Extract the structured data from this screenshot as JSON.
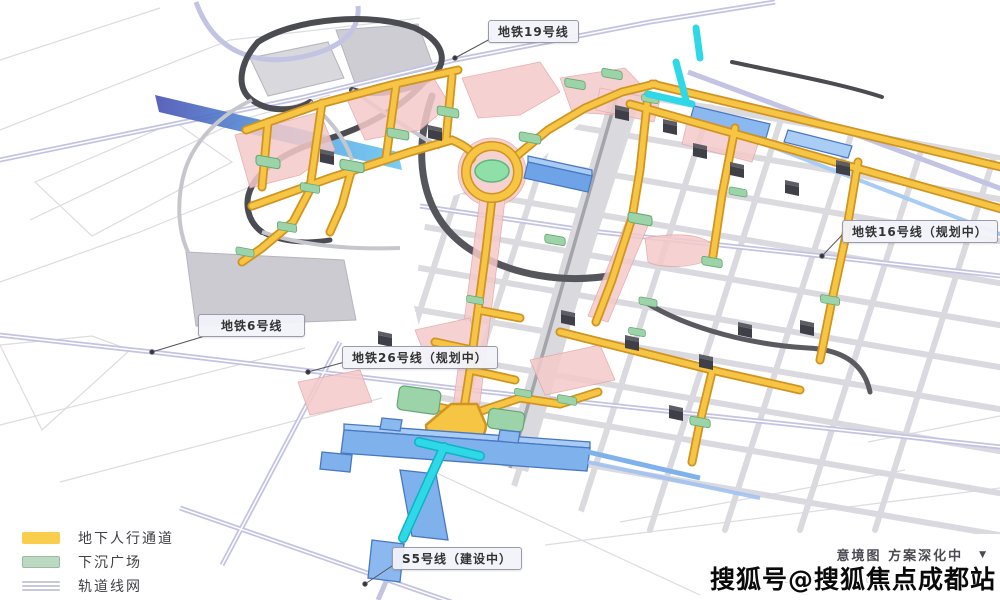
{
  "map": {
    "labels": {
      "line19": "地铁19号线",
      "line16": "地铁16号线（规划中）",
      "line6": "地铁6号线",
      "line26": "地铁26号线（规划中）",
      "s5": "S5号线（建设中）"
    },
    "colors": {
      "pedestrian_corridor": "#F6C544",
      "sunken_plaza": "#9CD3A8",
      "rail_network": "#C6C6E2",
      "metro_station_blue": "#7FB2EC",
      "under_construction_cyan": "#2FD8E6",
      "dark_road": "#4B4B52",
      "corridor_halo_pink": "#F5CACA"
    }
  },
  "legend": {
    "items": [
      {
        "label": "地下人行通道",
        "swatch": "corridor-yellow"
      },
      {
        "label": "下沉广场",
        "swatch": "plaza-green"
      },
      {
        "label": "轨道线网",
        "swatch": "rail-lines"
      }
    ]
  },
  "footer": {
    "caption": "意境图  方案深化中",
    "dropdown_icon": "▼",
    "faint_text": "CONCEPTUALIZATION",
    "watermark": "搜狐号@搜狐焦点成都站"
  }
}
